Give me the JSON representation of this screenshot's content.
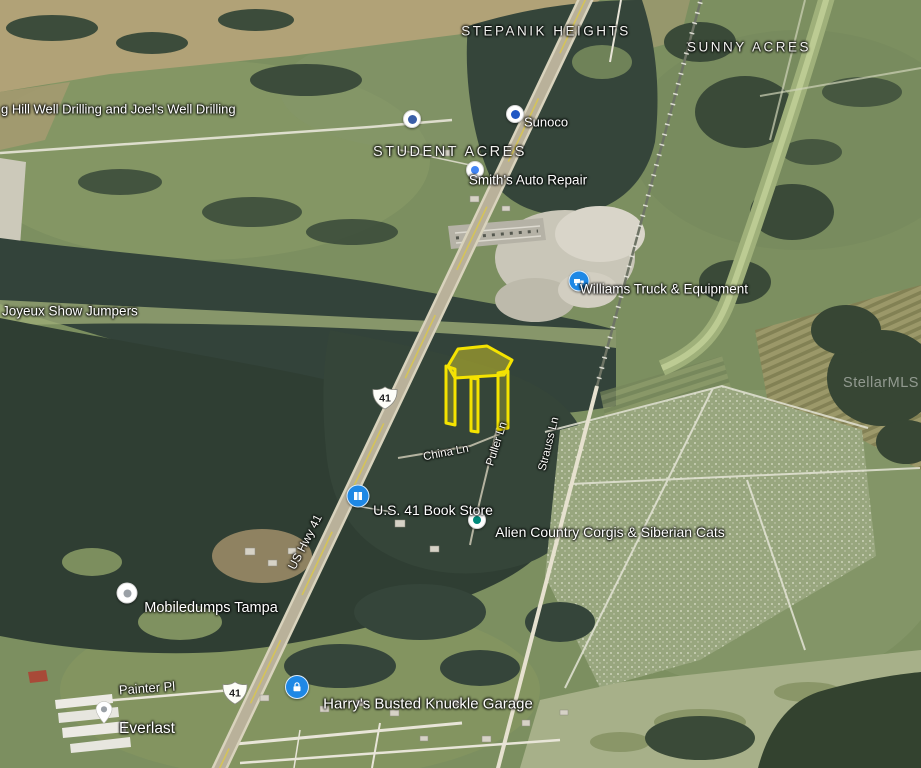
{
  "watermark": {
    "text": "StellarMLS"
  },
  "area_labels": {
    "stepanik_heights": "STEPANIK HEIGHTS",
    "sunny_acres": "SUNNY ACRES",
    "student_acres": "STUDENT ACRES"
  },
  "places": {
    "well_drilling": "g Hill Well Drilling and Joel's Well Drilling",
    "joyeux": "Joyeux Show Jumpers",
    "sunoco": "Sunoco",
    "smiths": "Smith's Auto Repair",
    "williams": "Williams Truck & Equipment",
    "bookstore": "U.S. 41 Book Store",
    "alien": "Alien Country Corgis & Siberian Cats",
    "mobiledumps": "Mobiledumps Tampa",
    "harrys": "Harry's Busted Knuckle Garage",
    "everlast": "Everlast"
  },
  "roads": {
    "us_hwy_41": "US Hwy 41",
    "china_ln": "China Ln",
    "puller_ln": "Puller Ln",
    "strauss_ln": "Strauss Ln",
    "painter_pl": "Painter Pl",
    "route_shield": "41"
  },
  "colors": {
    "parcel_outline": "#f5e300",
    "poi_pin_blue": "#1e88e5",
    "label_text": "#ffffff"
  }
}
